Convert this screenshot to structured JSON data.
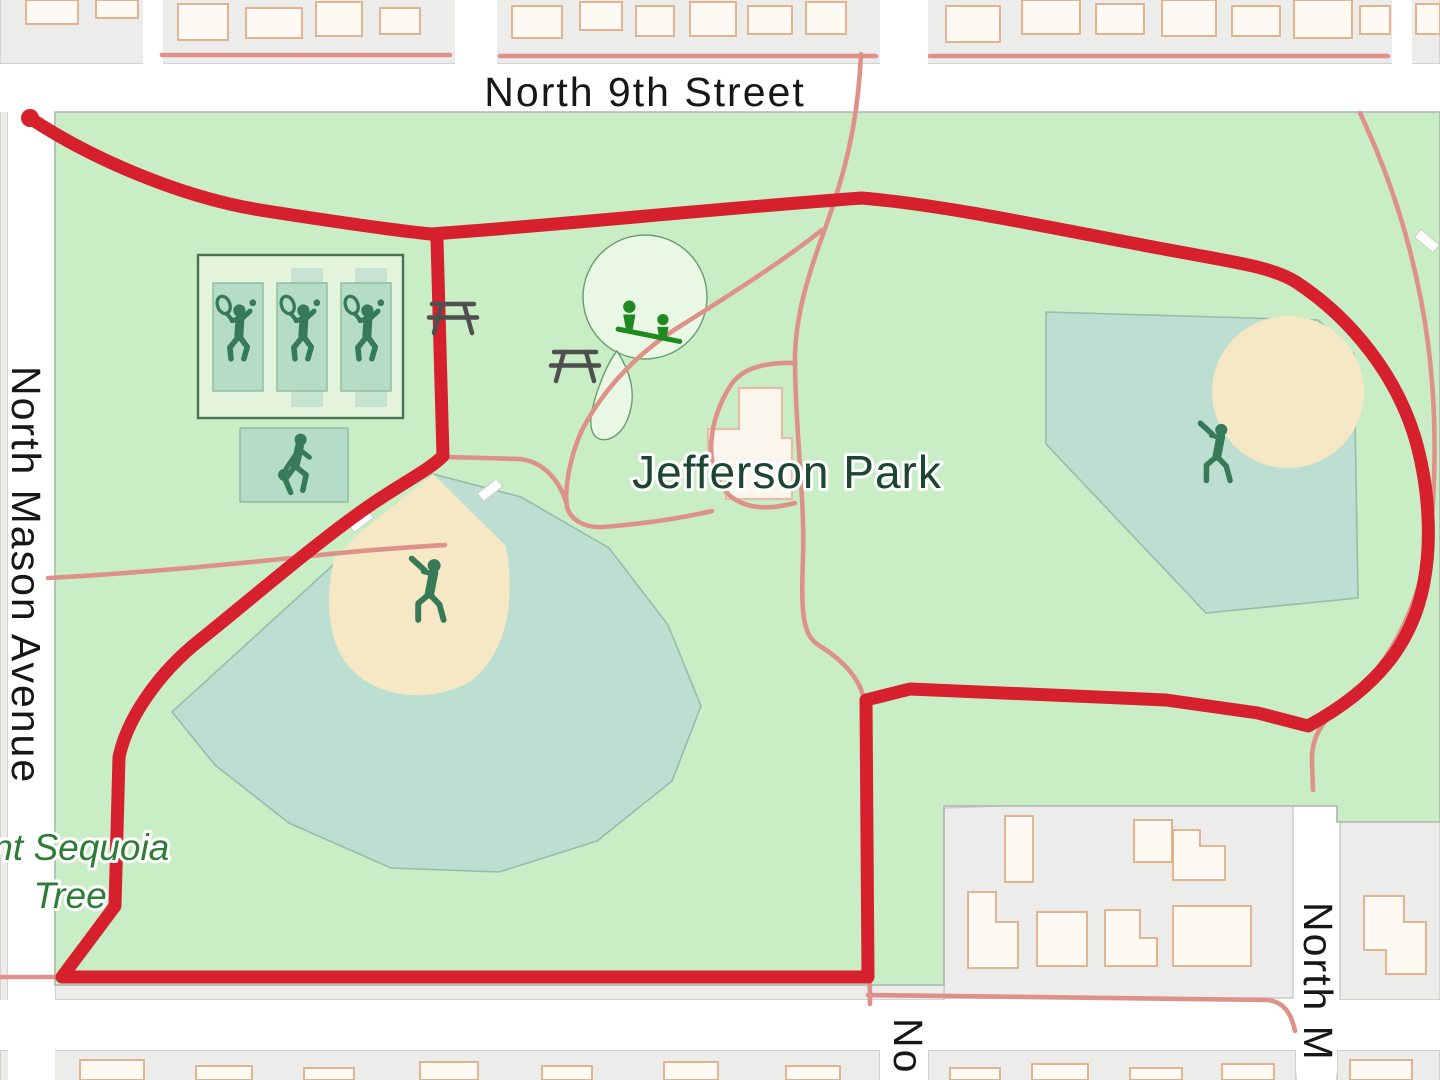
{
  "map": {
    "labels": {
      "street_top": "North 9th Street",
      "street_left": "North Mason Avenue",
      "street_right": "North M",
      "street_bottom": "No",
      "park_name": "Jefferson Park",
      "poi_line1": "Giant Sequoia",
      "poi_line2": "Tree"
    },
    "palette": {
      "street_white": "#ffffff",
      "block_gray": "#ececeb",
      "block_line": "#c9c9c9",
      "boundary_gray": "#aeb6ae",
      "park_green": "#c9eec5",
      "playground_mint": "#e9f8e4",
      "playground_line": "#689c70",
      "complex_fill": "#e3f3dc",
      "complex_line": "#49724f",
      "court_back": "#c6e4d1",
      "court_teal": "#b5dcc6",
      "court_line": "#8cbaa2",
      "field_teal": "#bcdfd2",
      "field_line": "#99bbac",
      "infield_tan": "#f6e8c4",
      "building_fill": "#fdf9f3",
      "building_line": "#e0ad85",
      "park_building_fill": "#faf6ee",
      "park_building_line": "#e4bda6",
      "road_salmon": "#dd9189",
      "route_red": "#d6202d",
      "label_dark": "#171717",
      "park_label": "#1d4631",
      "tree_label": "#2e7d36",
      "icon_green": "#377a58",
      "seesaw_green": "#1e8a1f",
      "picnic_gray": "#4f4f4f",
      "halo": "#ffffff"
    },
    "route": {
      "description": "red GPS track loop around Jefferson Park starting at dot on North Mason Avenue",
      "start": {
        "x": 30,
        "y": 118,
        "r": 9
      },
      "path_d": "M30,118 C90,158 180,197 260,210 C330,221 392,230 431,234 C560,225 700,210 862,198 C955,206 1075,233 1180,252 C1240,263 1274,268 1296,282 C1354,320 1397,378 1415,438 C1429,486 1432,540 1424,582 C1413,642 1378,688 1308,726 L1258,713 L1166,700 L910,689 L866,700 L868,977 L62,977 L115,906 L119,757 C127,719 158,673 200,640 C262,590 330,531 381,498 C410,479 431,468 443,456 L437,240"
    },
    "icons": [
      "tennis-player-icon",
      "tennis-player-icon",
      "tennis-player-icon",
      "basketball-player-icon",
      "baseball-player-icon",
      "baseball-player-icon",
      "seesaw-icon",
      "picnic-table-icon",
      "picnic-table-icon",
      "route-start-dot-icon"
    ],
    "features": [
      "tennis-courts",
      "basketball-court",
      "baseball-field-west",
      "baseball-field-east",
      "playground",
      "park-building",
      "residential-blocks"
    ]
  }
}
